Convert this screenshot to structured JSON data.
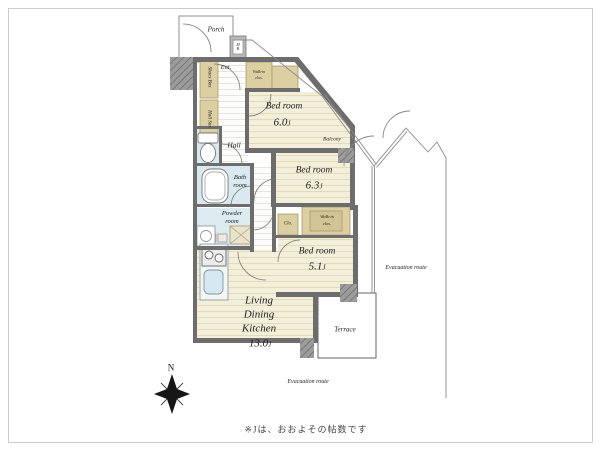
{
  "note": "※Jは、おおよその帖数です",
  "compass": {
    "north": "N"
  },
  "rooms": {
    "porch": {
      "label": "Porch"
    },
    "meter_box": {
      "label": "M B"
    },
    "entrance": {
      "label": "Ent."
    },
    "shoes_box": {
      "label": "Shoes Box"
    },
    "hall_storage": {
      "label": "Hall Sto."
    },
    "hall": {
      "label": "Hall"
    },
    "bath": {
      "line1": "Bath",
      "line2": "room"
    },
    "powder": {
      "line1": "Powder",
      "line2": "room"
    },
    "walk_in_closet_top": {
      "line1": "Walk-in",
      "line2": "clos."
    },
    "bedroom_60": {
      "name": "Bed room",
      "size": "6.0",
      "unit": "J"
    },
    "balcony": {
      "label": "Balcony"
    },
    "bedroom_63": {
      "name": "Bed room",
      "size": "6.3",
      "unit": "J"
    },
    "closet": {
      "label": "Clo."
    },
    "walk_in_closet_right": {
      "line1": "Walk-in",
      "line2": "clos."
    },
    "bedroom_51": {
      "name": "Bed room",
      "size": "5.1",
      "unit": "J"
    },
    "ldk": {
      "line1": "Living",
      "line2": "Dining",
      "line3": "Kitchen",
      "size": "13.0",
      "unit": "J"
    },
    "terrace": {
      "label": "Terrace"
    },
    "evacuation_route_right": {
      "label": "Evacuation route"
    },
    "evacuation_route_bottom": {
      "label": "Evacuation route"
    }
  }
}
